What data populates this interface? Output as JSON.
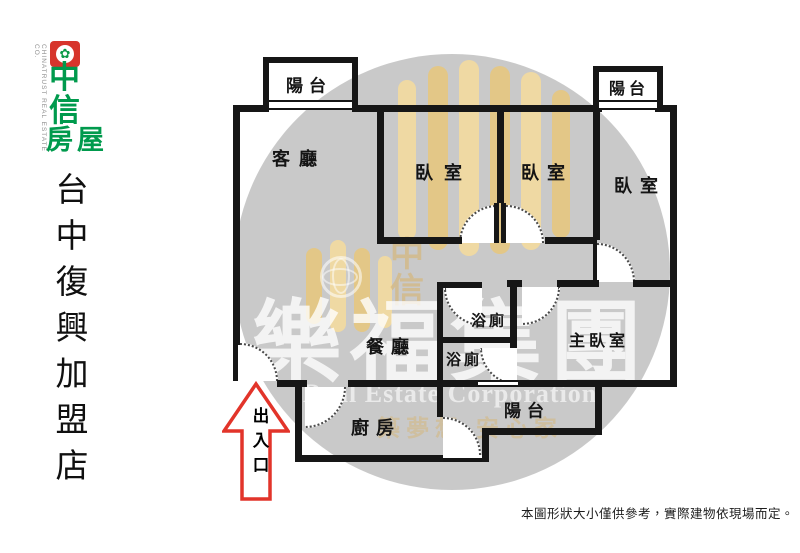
{
  "sidebar": {
    "brand": {
      "company_en": "CHINATRUST REAL ESTATE CO.",
      "logo_char_1": "中",
      "logo_char_2": "信",
      "logo_char_3": "房屋",
      "emblem_glyph": "✿",
      "brand_red": "#d7352c",
      "brand_green": "#009a4d"
    },
    "store_name": "台中復興加盟店"
  },
  "floorplan": {
    "rooms": [
      {
        "id": "balcony-top-left",
        "label": "陽台"
      },
      {
        "id": "living-room",
        "label": "客廳"
      },
      {
        "id": "bedroom-1",
        "label": "臥室"
      },
      {
        "id": "bedroom-2",
        "label": "臥室"
      },
      {
        "id": "balcony-top-right",
        "label": "陽台"
      },
      {
        "id": "bedroom-3",
        "label": "臥室"
      },
      {
        "id": "bathroom-1",
        "label": "浴廁"
      },
      {
        "id": "bathroom-2",
        "label": "浴廁"
      },
      {
        "id": "dining-room",
        "label": "餐廳"
      },
      {
        "id": "master-bedroom",
        "label": "主臥室"
      },
      {
        "id": "kitchen",
        "label": "廚房"
      },
      {
        "id": "balcony-bottom",
        "label": "陽台"
      }
    ],
    "entrance_label": "出入口",
    "wall_color": "#161616",
    "arrow_color": "#e2342a"
  },
  "watermark": {
    "group_name": "樂福集團",
    "group_name_en": "Real Estate Corporation",
    "logo_char_top": "中",
    "logo_char_bottom": "信",
    "slogan": "築夢想 安心家",
    "circle_color": "rgba(55,55,55,0.27)",
    "bar_color": "#f2daa0"
  },
  "disclaimer": "本圖形狀大小僅供參考，實際建物依現場而定。"
}
